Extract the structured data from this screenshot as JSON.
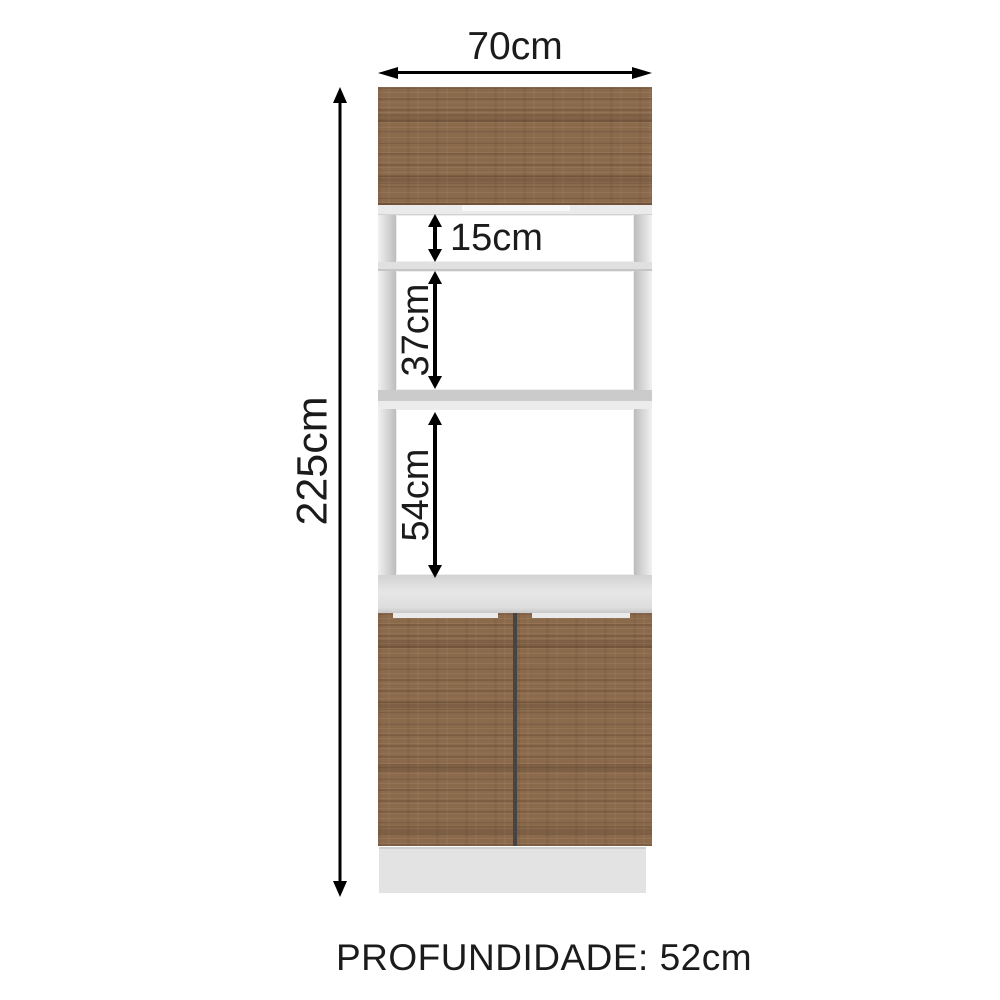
{
  "diagram": {
    "labels": {
      "width": "70cm",
      "height": "225cm",
      "niche_top": "15cm",
      "niche_middle": "37cm",
      "niche_bottom": "54cm",
      "depth": "PROFUNDIDADE: 52cm"
    },
    "colors": {
      "wood": "#8b6a4c",
      "woodShade": "#6f5239",
      "frameLight": "#f1f1f1",
      "frameDark": "#bdbdbd",
      "shelf": "#d9d9d9",
      "cavity": "#ffffff",
      "doorGap": "#454545",
      "plinth": "#e3e3e3",
      "arrow": "#000000",
      "text": "#1b1b1b",
      "background": "#ffffff"
    }
  }
}
